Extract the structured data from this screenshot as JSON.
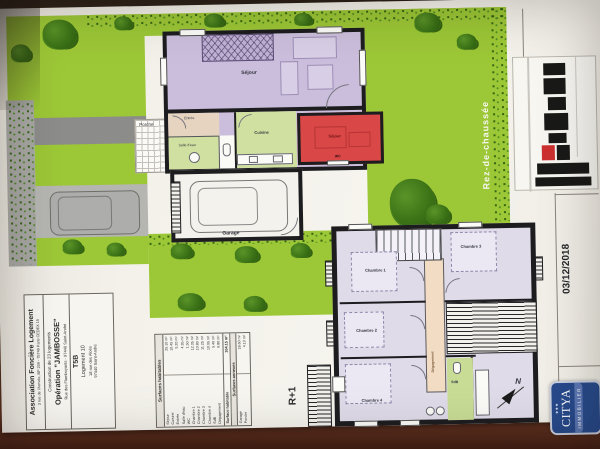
{
  "meta": {
    "date": "03/12/2018",
    "scale": "1/100",
    "compass_n": "N"
  },
  "floors": {
    "ground_label": "Rez-de-chaussée",
    "first_label": "R+1"
  },
  "rooms_ground": {
    "sejour": "Séjour",
    "cuisine": "Cuisine",
    "entree": "Entrée",
    "salle_eau": "Salle d'eau",
    "wc": "WC",
    "garage": "Garage",
    "porche": "Porche",
    "sejour_voisin": "Séjour"
  },
  "rooms_first": {
    "chambre1": "Chambre 1",
    "chambre2": "Chambre 2",
    "chambre3": "Chambre 3",
    "chambre4": "Chambre 4",
    "degagement": "Dégagement",
    "sdb": "SdB"
  },
  "title_block": {
    "org_name": "Association Foncière Logement",
    "org_address": "3 rue de l'Arrivée, BP 209 - 75749 Paris CEDEX 15",
    "project_line1": "Construction de 23 logements",
    "project_name": "Opération \"JAMBOSSE\"",
    "project_address": "Rue des Flamboyants - 97440 Saint-André",
    "unit_type": "T5B",
    "unit_number": "Logement 10",
    "unit_address1": "18 rue des Aloès",
    "unit_address2": "97440 Saint-André"
  },
  "surface_table": {
    "title": "Surfaces habitables",
    "names": "Séjour\nCuisine\nEntrée\nSalle d'eau\nWC\nChambre 1\nChambre 2\nChambre 3\nChambre 4\nSdB\nDégagement",
    "values": "25.10 m²\n10.45 m²\n5.20 m²\n4.35 m²\n1.50 m²\n12.35 m²\n10.80 m²\n11.25 m²\n10.95 m²\n5.40 m²\n6.80 m²",
    "total_label": "Surface habitable",
    "total_value": "104.15 m²",
    "annex_title": "Surfaces annexes",
    "annex_names": "Garage\nPorche",
    "annex_values": "18.60 m²\n4.10 m²"
  },
  "logo": {
    "brand": "CITYA",
    "sub": "IMMOBILIER"
  },
  "colors": {
    "garden": "#9cc736",
    "room_violet": "#cbbedc",
    "room_green": "#cfe0a0",
    "room_red": "#d94747",
    "room_tan": "#e6d4c0",
    "corridor": "#f2dcc3",
    "logo_blue": "#274a8c"
  }
}
